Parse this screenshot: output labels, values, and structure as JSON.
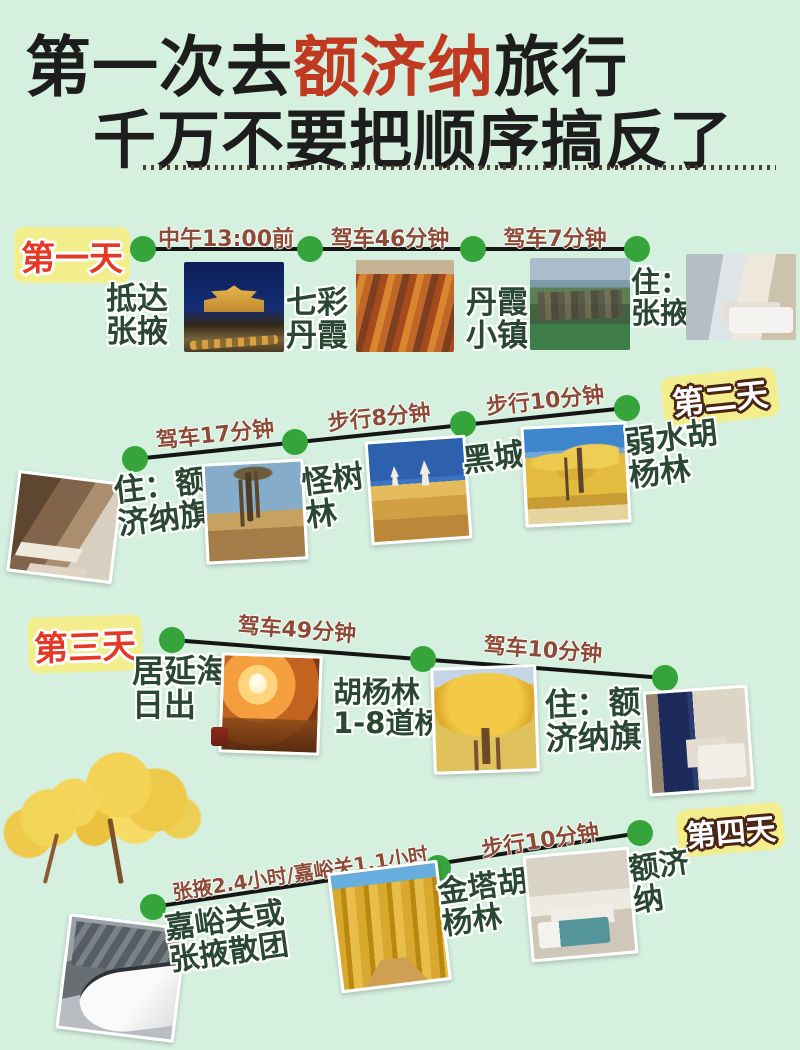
{
  "title": {
    "line1_prefix": "第一次去",
    "line1_highlight": "额济纳",
    "line1_suffix": "旅行",
    "line2": "千万不要把顺序搞反了"
  },
  "colors": {
    "background": "#d6f0e0",
    "badge_bg": "#f3ee8d",
    "badge_red_text": "#e53927",
    "badge_white_outline": "#4a2414",
    "segment_label": "#8d4a36",
    "stop_label": "#294733",
    "timeline_dot": "#35a43a",
    "timeline_line": "#151515",
    "title_highlight": "#c03a22"
  },
  "days": [
    {
      "badge": "第一天",
      "segments": [
        {
          "label": "中午13:00前"
        },
        {
          "label": "驾车46分钟"
        },
        {
          "label": "驾车7分钟"
        }
      ],
      "stops": [
        {
          "label": "抵达\n张掖",
          "photo": "zhangye-night-photo"
        },
        {
          "label": "七彩\n丹霞",
          "photo": "qicai-danxia-photo"
        },
        {
          "label": "丹霞\n小镇",
          "photo": "danxia-town-photo"
        },
        {
          "label": "住：\n张掖",
          "photo": "zhangye-hotel-photo"
        }
      ]
    },
    {
      "badge": "第二天",
      "segments": [
        {
          "label": "驾车17分钟"
        },
        {
          "label": "步行8分钟"
        },
        {
          "label": "步行10分钟"
        }
      ],
      "stops": [
        {
          "label": "住：额\n济纳旗",
          "photo": "ejinaqi-hotel-photo"
        },
        {
          "label": "怪树\n林",
          "photo": "guaishulin-photo"
        },
        {
          "label": "黑城",
          "photo": "heicheng-photo"
        },
        {
          "label": "弱水胡\n杨林",
          "photo": "ruoshui-populus-photo"
        }
      ]
    },
    {
      "badge": "第三天",
      "segments": [
        {
          "label": "驾车49分钟"
        },
        {
          "label": "驾车10分钟"
        }
      ],
      "stops": [
        {
          "label": "居延海\n日出",
          "photo": "juyanhai-sunrise-photo"
        },
        {
          "label": "胡杨林\n1-8道桥",
          "photo": "populus-bridges-photo"
        },
        {
          "label": "住：额\n济纳旗",
          "photo": "ejinaqi-hotel-photo-2"
        }
      ]
    },
    {
      "badge": "第四天",
      "segments": [
        {
          "label": "张掖2.4小时/嘉峪关1.1小时"
        },
        {
          "label": "步行10分钟"
        }
      ],
      "stops": [
        {
          "label": "嘉峪关或\n张掖散团",
          "photo": "jiayuguan-train-photo"
        },
        {
          "label": "金塔胡\n杨林",
          "photo": "jinta-populus-photo"
        },
        {
          "label": "额济\n纳",
          "photo": "ejina-hotel-photo"
        }
      ]
    }
  ]
}
